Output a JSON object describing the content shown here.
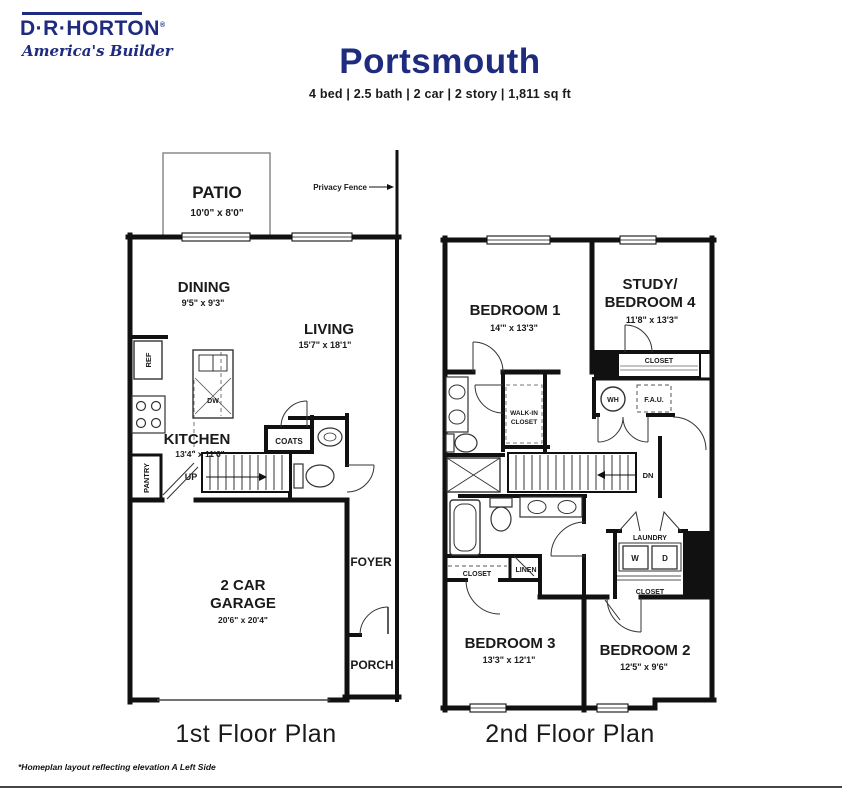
{
  "brand": {
    "name": "D·R·HORTON",
    "reg": "®",
    "tagline": "America's Builder"
  },
  "header": {
    "title": "Portsmouth",
    "specs": "4 bed | 2.5 bath | 2 car | 2 story | 1,811 sq ft"
  },
  "floor1": {
    "caption": "1st Floor Plan",
    "fence_label": "Privacy Fence",
    "patio": {
      "name": "PATIO",
      "dims": "10'0\" x 8'0\""
    },
    "dining": {
      "name": "DINING",
      "dims": "9'5\" x 9'3\""
    },
    "living": {
      "name": "LIVING",
      "dims": "15'7\" x 18'1\""
    },
    "kitchen": {
      "name": "KITCHEN",
      "dims": "13'4\" x 11'6\""
    },
    "garage": {
      "line1": "2 CAR",
      "line2": "GARAGE",
      "dims": "20'6\" x 20'4\""
    },
    "foyer": "FOYER",
    "porch": "PORCH",
    "pantry": "PANTRY",
    "coats": "COATS",
    "ref": "REF",
    "dw": "DW",
    "up": "UP"
  },
  "floor2": {
    "caption": "2nd Floor Plan",
    "bedroom1": {
      "name": "BEDROOM 1",
      "dims": "14'\" x 13'3\""
    },
    "study": {
      "line1": "STUDY/",
      "line2": "BEDROOM 4",
      "dims": "11'8\" x 13'3\""
    },
    "bedroom2": {
      "name": "BEDROOM 2",
      "dims": "12'5\" x 9'6\""
    },
    "bedroom3": {
      "name": "BEDROOM 3",
      "dims": "13'3\" x 12'1\""
    },
    "walk_in": {
      "line1": "WALK-IN",
      "line2": "CLOSET"
    },
    "laundry": "LAUNDRY",
    "washer": "W",
    "dryer": "D",
    "closet_study": "CLOSET",
    "closet_bed2": "CLOSET",
    "closet_bed3": "CLOSET",
    "linen": "LINEN",
    "water_heater": "WH",
    "fau": "F.A.U.",
    "down": "DN"
  },
  "footnote": "*Homeplan layout reflecting elevation A Left Side"
}
